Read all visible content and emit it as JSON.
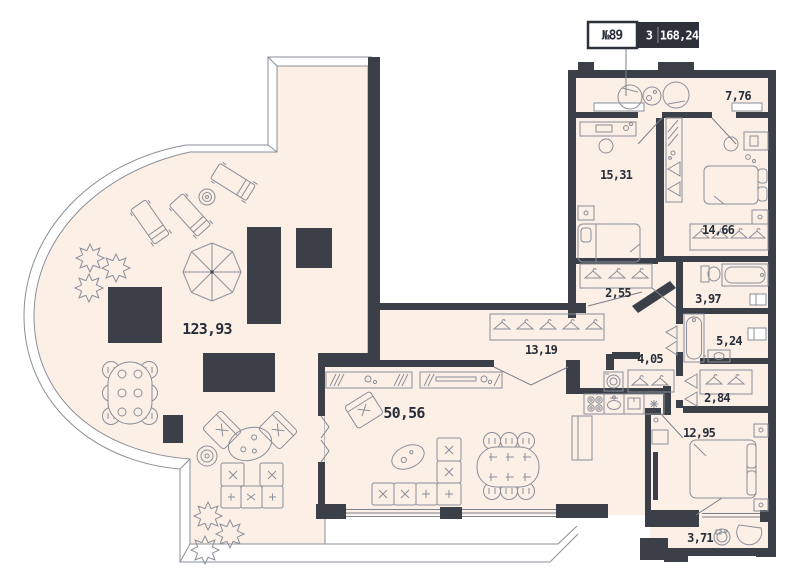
{
  "badge": {
    "number": "№89",
    "rooms_count": "3",
    "total_area": "168,24"
  },
  "rooms": {
    "terrace": {
      "name": "terrace",
      "area": "123,93"
    },
    "entrance_hall": {
      "name": "entrance hall",
      "area": "7,76"
    },
    "bedroom_1": {
      "name": "bedroom 1",
      "area": "15,31"
    },
    "bedroom_2": {
      "name": "bedroom 2",
      "area": "14,66"
    },
    "wardrobe_1": {
      "name": "wardrobe",
      "area": "2,55"
    },
    "bathroom_1": {
      "name": "bathroom",
      "area": "3,97"
    },
    "corridor": {
      "name": "corridor",
      "area": "13,19"
    },
    "hallway": {
      "name": "hallway",
      "area": "4,05"
    },
    "bathroom_2": {
      "name": "bathroom",
      "area": "5,24"
    },
    "wardrobe_2": {
      "name": "wardrobe",
      "area": "2,84"
    },
    "bedroom_3": {
      "name": "bedroom 3",
      "area": "12,95"
    },
    "bathroom_3": {
      "name": "shower room",
      "area": "3,71"
    },
    "living_kitchen": {
      "name": "kitchen-living",
      "area": "50,56"
    }
  },
  "colors": {
    "wall": "#3a3f48",
    "floor": "#fcefe6",
    "line": "#8a8f99",
    "label": "#272e3a",
    "badge_bg": "#2c313a",
    "badge_text": "#ffffff"
  }
}
